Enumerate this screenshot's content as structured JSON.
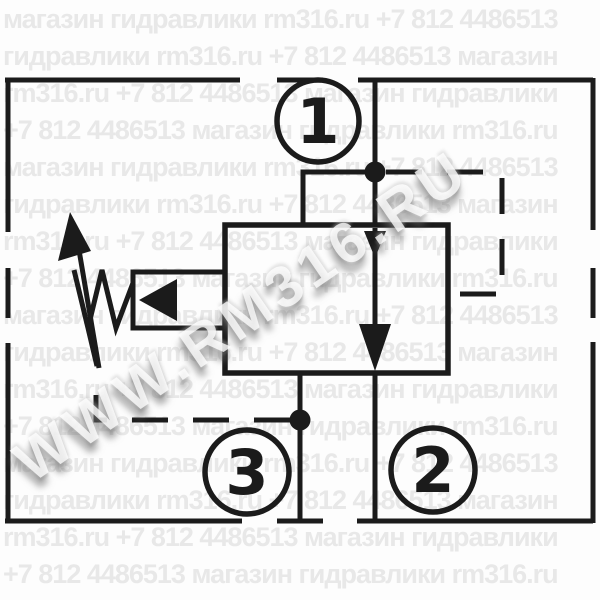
{
  "watermark": {
    "tiled_color": "#e8e8e8",
    "diagonal_text": "WWW.RM316.RU",
    "rows": [
      "магазин гидравлики rm316.ru +7 812 4486513",
      "гидравлики rm316.ru +7 812 4486513 магазин",
      "rm316.ru +7 812 4486513 магазин гидравлики",
      "+7 812 4486513 магазин гидравлики rm316.ru",
      "магазин гидравлики rm316.ru +7 812 4486513",
      "гидравлики rm316.ru +7 812 4486513 магазин",
      "rm316.ru +7 812 4486513 магазин гидравлики",
      "+7 812 4486513 магазин гидравлики rm316.ru",
      "магазин гидравлики rm316.ru +7 812 4486513",
      "гидравлики rm316.ru +7 812 4486513 магазин",
      "rm316.ru +7 812 4486513 магазин гидравлики",
      "+7 812 4486513 магазин гидравлики rm316.ru",
      "магазин гидравлики rm316.ru +7 812 4486513",
      "гидравлики rm316.ru +7 812 4486513 магазин",
      "rm316.ru +7 812 4486513 магазин гидравлики",
      "+7 812 4486513 магазин гидравлики rm316.ru"
    ]
  },
  "schematic": {
    "line_color": "#1b1b1b",
    "ports": [
      {
        "label": "1"
      },
      {
        "label": "2"
      },
      {
        "label": "3"
      }
    ]
  }
}
